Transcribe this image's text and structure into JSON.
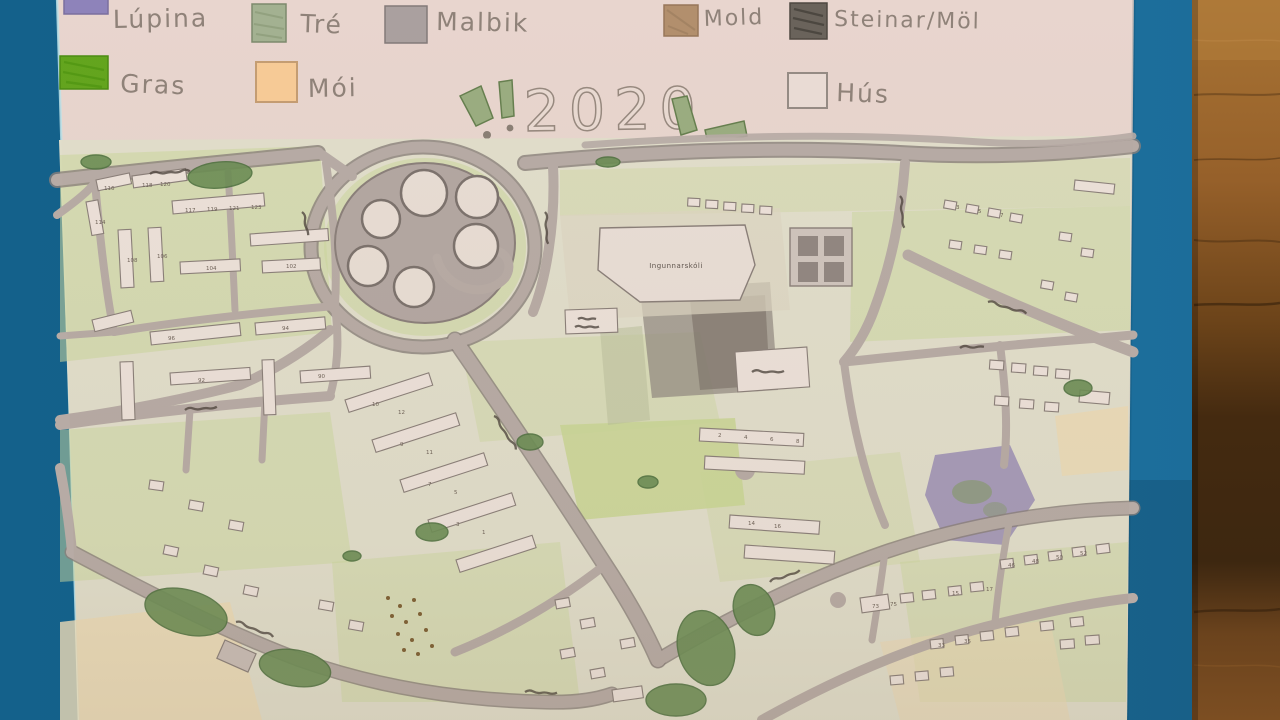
{
  "legend": {
    "items": [
      {
        "id": "lupina",
        "label": "Lúpina",
        "color": "#8e83ba"
      },
      {
        "id": "tre",
        "label": "Tré",
        "color": "#a3b191"
      },
      {
        "id": "malbik",
        "label": "Malbik",
        "color": "#aaa09f"
      },
      {
        "id": "mold",
        "label": "Mold",
        "color": "#b28f6d"
      },
      {
        "id": "steinar",
        "label": "Steinar/Möl",
        "color": "#6a635b"
      },
      {
        "id": "gras",
        "label": "Gras",
        "color": "#63a51e"
      },
      {
        "id": "moi",
        "label": "Mói",
        "color": "#f7cb97"
      },
      {
        "id": "hus",
        "label": "Hús",
        "color": "#eadcd5"
      }
    ]
  },
  "title": {
    "text": "2020",
    "exclamation": "!"
  },
  "map": {
    "school_label": "Ingunnarskóli",
    "water_tank_count": 6,
    "house_numbers": [
      {
        "x": 142,
        "y": 187,
        "v": "118"
      },
      {
        "x": 160,
        "y": 186,
        "v": "120"
      },
      {
        "x": 185,
        "y": 212,
        "v": "117"
      },
      {
        "x": 207,
        "y": 211,
        "v": "119"
      },
      {
        "x": 229,
        "y": 210,
        "v": "121"
      },
      {
        "x": 251,
        "y": 209,
        "v": "123"
      },
      {
        "x": 104,
        "y": 190,
        "v": "116"
      },
      {
        "x": 95,
        "y": 224,
        "v": "114"
      },
      {
        "x": 127,
        "y": 262,
        "v": "108"
      },
      {
        "x": 157,
        "y": 258,
        "v": "106"
      },
      {
        "x": 206,
        "y": 270,
        "v": "104"
      },
      {
        "x": 286,
        "y": 268,
        "v": "102"
      },
      {
        "x": 168,
        "y": 340,
        "v": "96"
      },
      {
        "x": 282,
        "y": 330,
        "v": "94"
      },
      {
        "x": 198,
        "y": 382,
        "v": "92"
      },
      {
        "x": 318,
        "y": 378,
        "v": "90"
      },
      {
        "x": 372,
        "y": 406,
        "v": "10"
      },
      {
        "x": 398,
        "y": 414,
        "v": "12"
      },
      {
        "x": 400,
        "y": 446,
        "v": "9"
      },
      {
        "x": 426,
        "y": 454,
        "v": "11"
      },
      {
        "x": 428,
        "y": 486,
        "v": "7"
      },
      {
        "x": 454,
        "y": 494,
        "v": "5"
      },
      {
        "x": 456,
        "y": 526,
        "v": "3"
      },
      {
        "x": 482,
        "y": 534,
        "v": "1"
      },
      {
        "x": 718,
        "y": 437,
        "v": "2"
      },
      {
        "x": 744,
        "y": 439,
        "v": "4"
      },
      {
        "x": 770,
        "y": 441,
        "v": "6"
      },
      {
        "x": 796,
        "y": 443,
        "v": "8"
      },
      {
        "x": 748,
        "y": 525,
        "v": "14"
      },
      {
        "x": 774,
        "y": 528,
        "v": "16"
      },
      {
        "x": 872,
        "y": 608,
        "v": "73"
      },
      {
        "x": 890,
        "y": 606,
        "v": "75"
      },
      {
        "x": 952,
        "y": 595,
        "v": "15"
      },
      {
        "x": 986,
        "y": 591,
        "v": "17"
      },
      {
        "x": 1008,
        "y": 567,
        "v": "46"
      },
      {
        "x": 1032,
        "y": 563,
        "v": "48"
      },
      {
        "x": 1056,
        "y": 559,
        "v": "50"
      },
      {
        "x": 1080,
        "y": 555,
        "v": "52"
      },
      {
        "x": 938,
        "y": 647,
        "v": "33"
      },
      {
        "x": 964,
        "y": 643,
        "v": "35"
      },
      {
        "x": 956,
        "y": 209,
        "v": "3"
      },
      {
        "x": 978,
        "y": 213,
        "v": "5"
      },
      {
        "x": 1000,
        "y": 217,
        "v": "7"
      }
    ]
  },
  "colors": {
    "board_blue": "#17628a",
    "wood_floor": "#9c6830",
    "paper": "#e8d5ce",
    "map_base": "#e1decb",
    "road": "#b7aba5",
    "grass_light": "#ccd79e",
    "tree_dark": "#6b8d54",
    "pencil_gray": "#8f8279"
  }
}
